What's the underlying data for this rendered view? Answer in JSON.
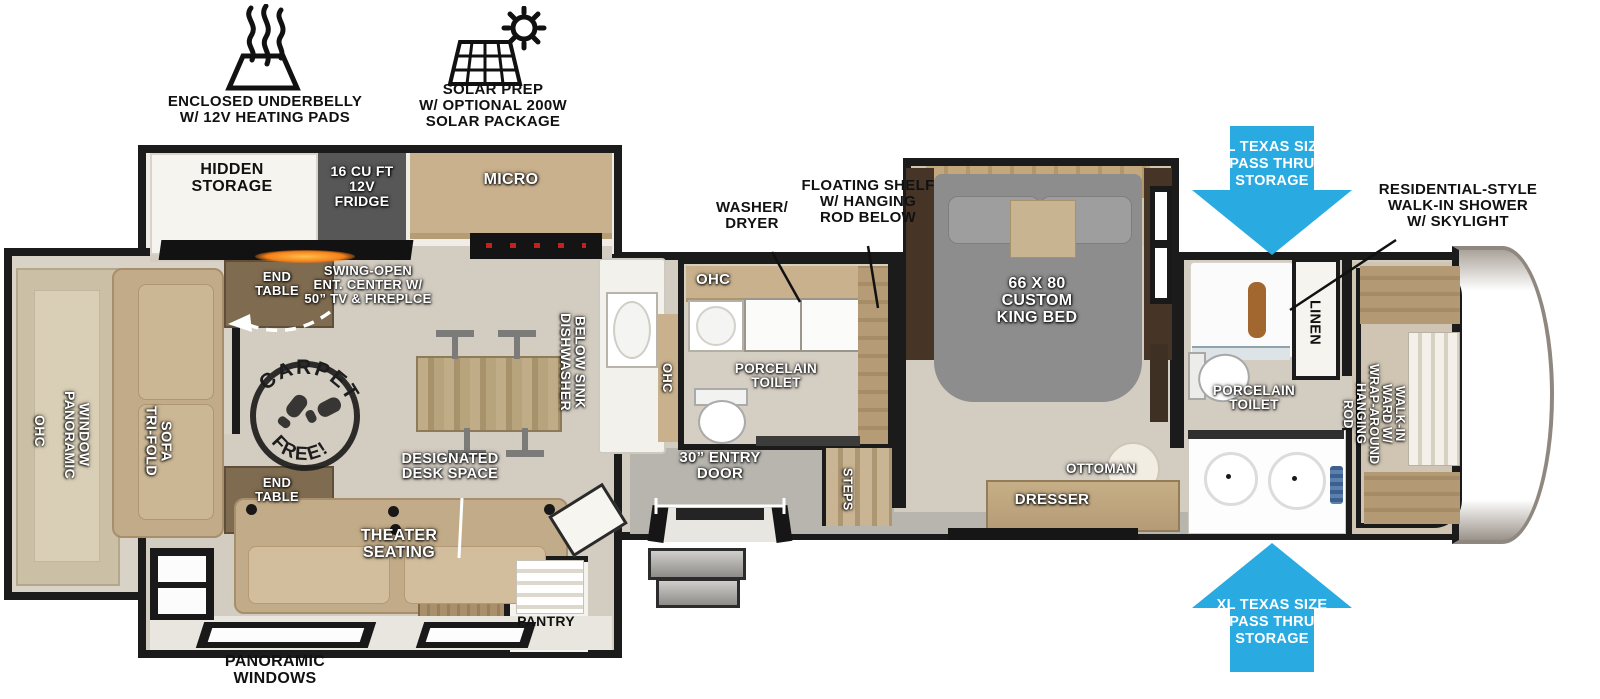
{
  "colors": {
    "arrow_blue": "#29ABE2",
    "wall_black": "#1b1b1b",
    "floor_tan": "#d3ccc1",
    "cabinet_tan": "#c9b18d",
    "wood_dark": "#7f6c50",
    "sofa_tan": "#c2ab88",
    "bed_gray": "#8d8d8d",
    "fridge_gray": "#575757"
  },
  "feature_icons": {
    "underbelly": {
      "icon": "heating-pads-icon",
      "label": "ENCLOSED UNDERBELLY\nW/ 12V HEATING PADS"
    },
    "solar": {
      "icon": "solar-panel-sun-icon",
      "label": "SOLAR PREP\nW/ OPTIONAL 200W\nSOLAR PACKAGE"
    }
  },
  "floorplan": {
    "kitchen": {
      "hidden_storage": "HIDDEN\nSTORAGE",
      "fridge": "16 CU FT\n12V\nFRIDGE",
      "micro": "MICRO",
      "ent_center": "SWING-OPEN\nENT. CENTER W/\n50” TV & FIREPLCE",
      "dishwasher": "DISHWASHER\nBELOW SINK",
      "ohc_sink": "OHC"
    },
    "living": {
      "end_table_top": "END\nTABLE",
      "end_table_bottom": "END\nTABLE",
      "ohc": "OHC",
      "panoramic_window": "PANORAMIC\nWINDOW",
      "sofa": "TRI-FOLD\nSOFA",
      "carpet_stamp_top": "CARPET",
      "carpet_stamp_bottom": "FREE!",
      "theater": "THEATER\nSEATING",
      "desk": "DESIGNATED\nDESK SPACE",
      "pantry": "PANTRY",
      "panoramic_windows": "PANORAMIC\nWINDOWS"
    },
    "mid_bath": {
      "ohc": "OHC",
      "toilet": "PORCELAIN\nTOILET",
      "washer_dryer": "WASHER/\nDRYER",
      "floating_shelf": "FLOATING SHELF\nW/ HANGING\nROD BELOW"
    },
    "entry": {
      "door": "30” ENTRY\nDOOR",
      "steps": "STEPS"
    },
    "bedroom": {
      "bed": "66 X 80\nCUSTOM\nKING BED",
      "ottoman": "OTTOMAN",
      "dresser": "DRESSER"
    },
    "rear_bath": {
      "shower_callout": "RESIDENTIAL-STYLE\nWALK-IN SHOWER\nW/ SKYLIGHT",
      "linen": "LINEN",
      "toilet": "PORCELAIN\nTOILET",
      "ward": "WALK-IN\nWARD W/\nWRAP-AROUND\nHANGING\nROD"
    },
    "storage_arrows": {
      "top": "XL TEXAS SIZE\nPASS THRU\nSTORAGE",
      "bottom": "XL TEXAS SIZE\nPASS THRU\nSTORAGE"
    }
  }
}
